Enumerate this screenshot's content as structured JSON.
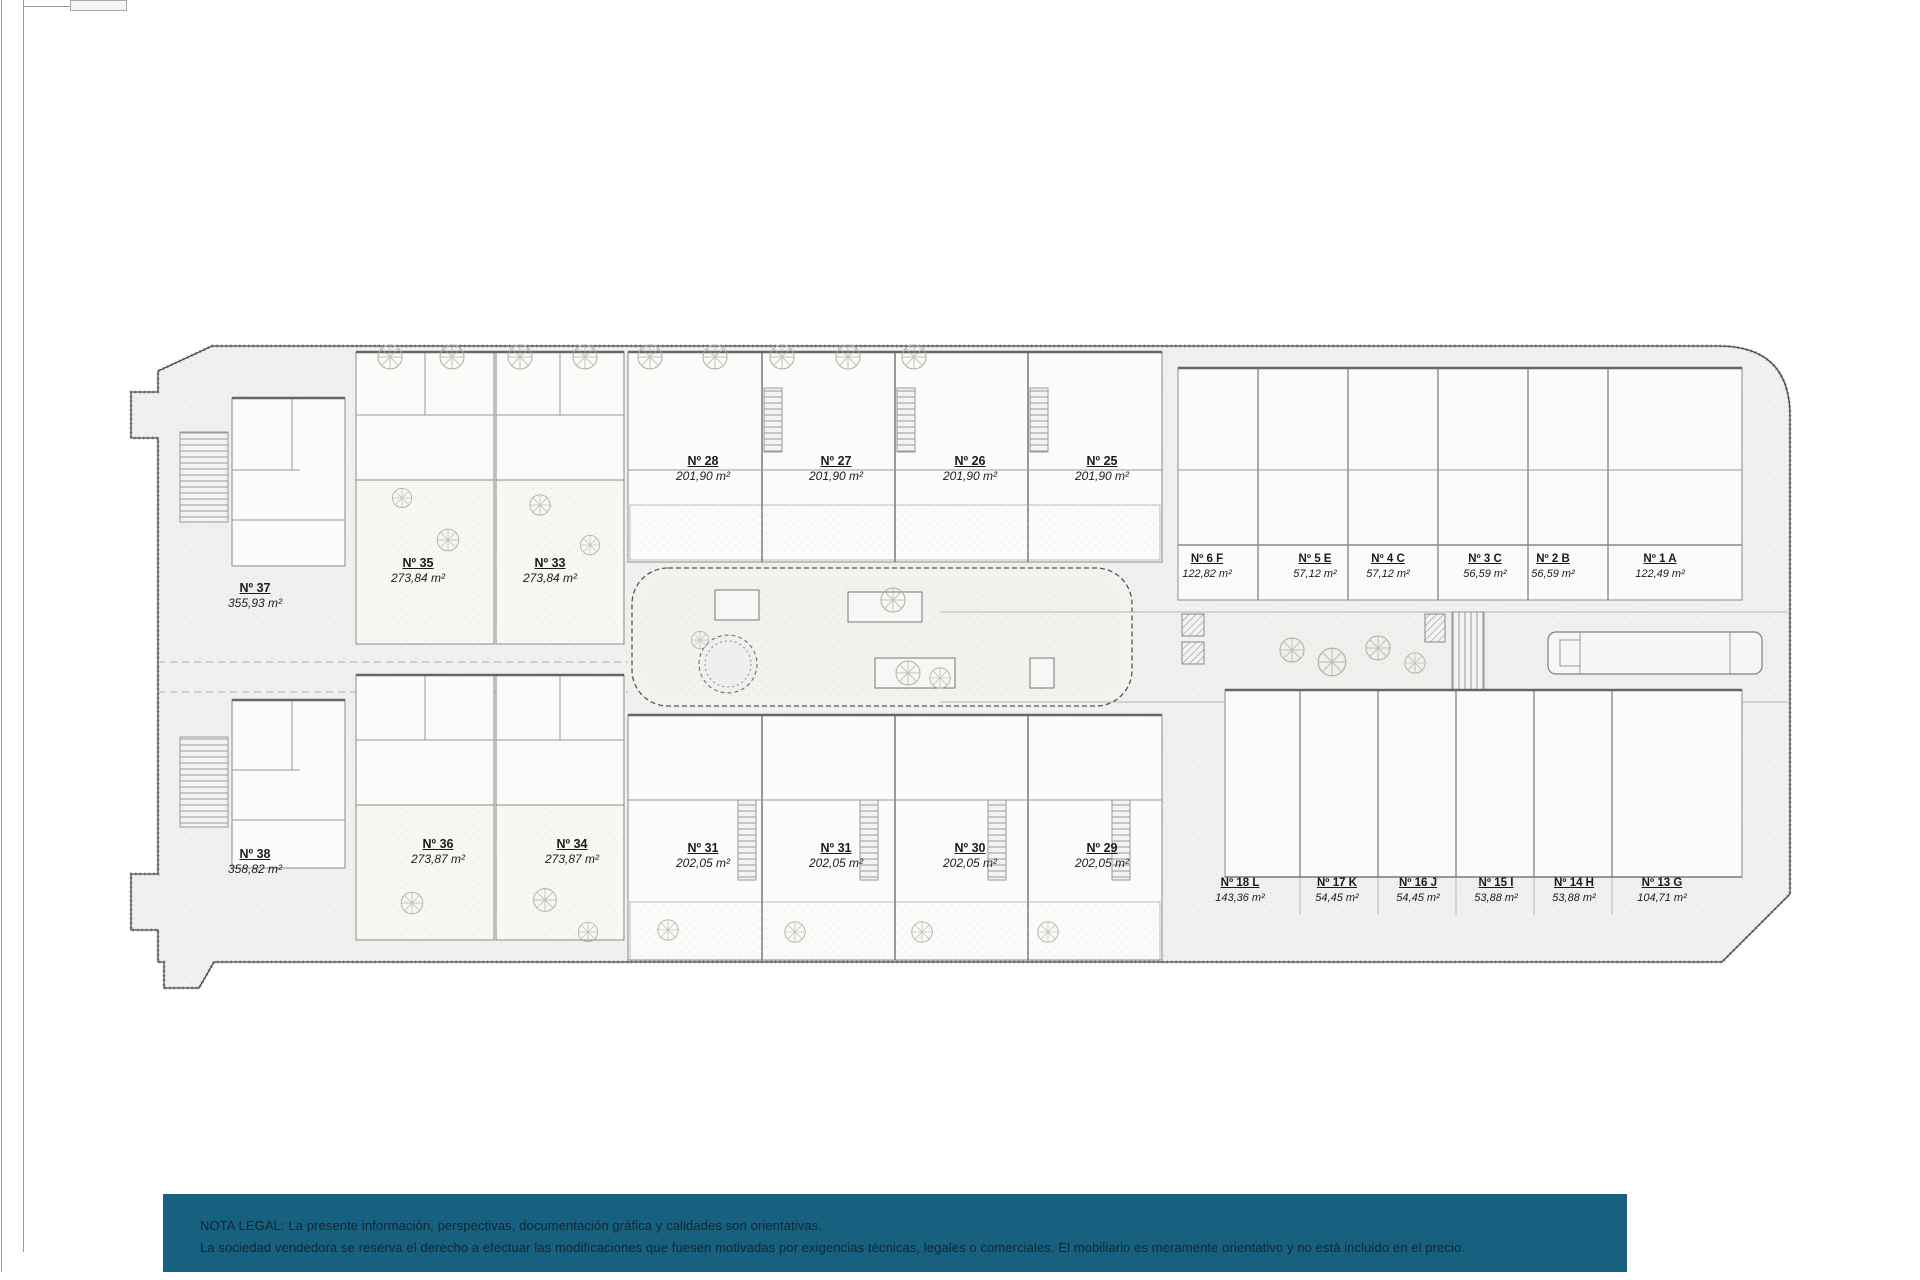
{
  "document": {
    "type": "residential site plan",
    "background": "#ffffff"
  },
  "plan": {
    "units": [
      {
        "id": "Nº 37",
        "area": "355,93 m²",
        "x": 255,
        "y": 581
      },
      {
        "id": "Nº 35",
        "area": "273,84 m²",
        "x": 418,
        "y": 556
      },
      {
        "id": "Nº 33",
        "area": "273,84 m²",
        "x": 550,
        "y": 556
      },
      {
        "id": "Nº 28",
        "area": "201,90 m²",
        "x": 703,
        "y": 454
      },
      {
        "id": "Nº 27",
        "area": "201,90 m²",
        "x": 836,
        "y": 454
      },
      {
        "id": "Nº 26",
        "area": "201,90 m²",
        "x": 970,
        "y": 454
      },
      {
        "id": "Nº 25",
        "area": "201,90 m²",
        "x": 1102,
        "y": 454
      },
      {
        "id": "Nº 6 F",
        "area": "122,82 m²",
        "x": 1207,
        "y": 552,
        "cls": "sm"
      },
      {
        "id": "Nº 5 E",
        "area": "57,12 m²",
        "x": 1315,
        "y": 552,
        "cls": "sm"
      },
      {
        "id": "Nº 4 C",
        "area": "57,12 m²",
        "x": 1388,
        "y": 552,
        "cls": "sm"
      },
      {
        "id": "Nº 3 C",
        "area": "56,59 m²",
        "x": 1485,
        "y": 552,
        "cls": "sm"
      },
      {
        "id": "Nº 2 B",
        "area": "56,59 m²",
        "x": 1553,
        "y": 552,
        "cls": "sm"
      },
      {
        "id": "Nº 1 A",
        "area": "122,49 m²",
        "x": 1660,
        "y": 552,
        "cls": "sm"
      },
      {
        "id": "Nº 38",
        "area": "358,82 m²",
        "x": 255,
        "y": 847
      },
      {
        "id": "Nº 36",
        "area": "273,87 m²",
        "x": 438,
        "y": 837
      },
      {
        "id": "Nº 34",
        "area": "273,87 m²",
        "x": 572,
        "y": 837
      },
      {
        "id": "Nº 31",
        "area": "202,05 m²",
        "x": 703,
        "y": 841
      },
      {
        "id": "Nº 31",
        "area": "202,05 m²",
        "x": 836,
        "y": 841
      },
      {
        "id": "Nº 30",
        "area": "202,05 m²",
        "x": 970,
        "y": 841
      },
      {
        "id": "Nº 29",
        "area": "202,05 m²",
        "x": 1102,
        "y": 841
      },
      {
        "id": "Nº 18 L",
        "area": "143,36 m²",
        "x": 1240,
        "y": 876,
        "cls": "sm"
      },
      {
        "id": "Nº 17 K",
        "area": "54,45 m²",
        "x": 1337,
        "y": 876,
        "cls": "sm"
      },
      {
        "id": "Nº 16 J",
        "area": "54,45 m²",
        "x": 1418,
        "y": 876,
        "cls": "sm"
      },
      {
        "id": "Nº 15 I",
        "area": "53,88 m²",
        "x": 1496,
        "y": 876,
        "cls": "sm"
      },
      {
        "id": "Nº 14 H",
        "area": "53,88 m²",
        "x": 1574,
        "y": 876,
        "cls": "sm"
      },
      {
        "id": "Nº 13 G",
        "area": "104,71 m²",
        "x": 1662,
        "y": 876,
        "cls": "sm"
      }
    ]
  },
  "legal": {
    "background": "#17607f",
    "line1": "NOTA LEGAL: La presente información, perspectivas, documentación gráfica y calidades son orientativas.",
    "line2": "La sociedad vendedora se reserva el derecho a efectuar las modificaciones que fuesen motivadas por exigencias técnicas, legales o comerciales. El mobiliario es meramente orientativo y no está incluido en el precio."
  }
}
